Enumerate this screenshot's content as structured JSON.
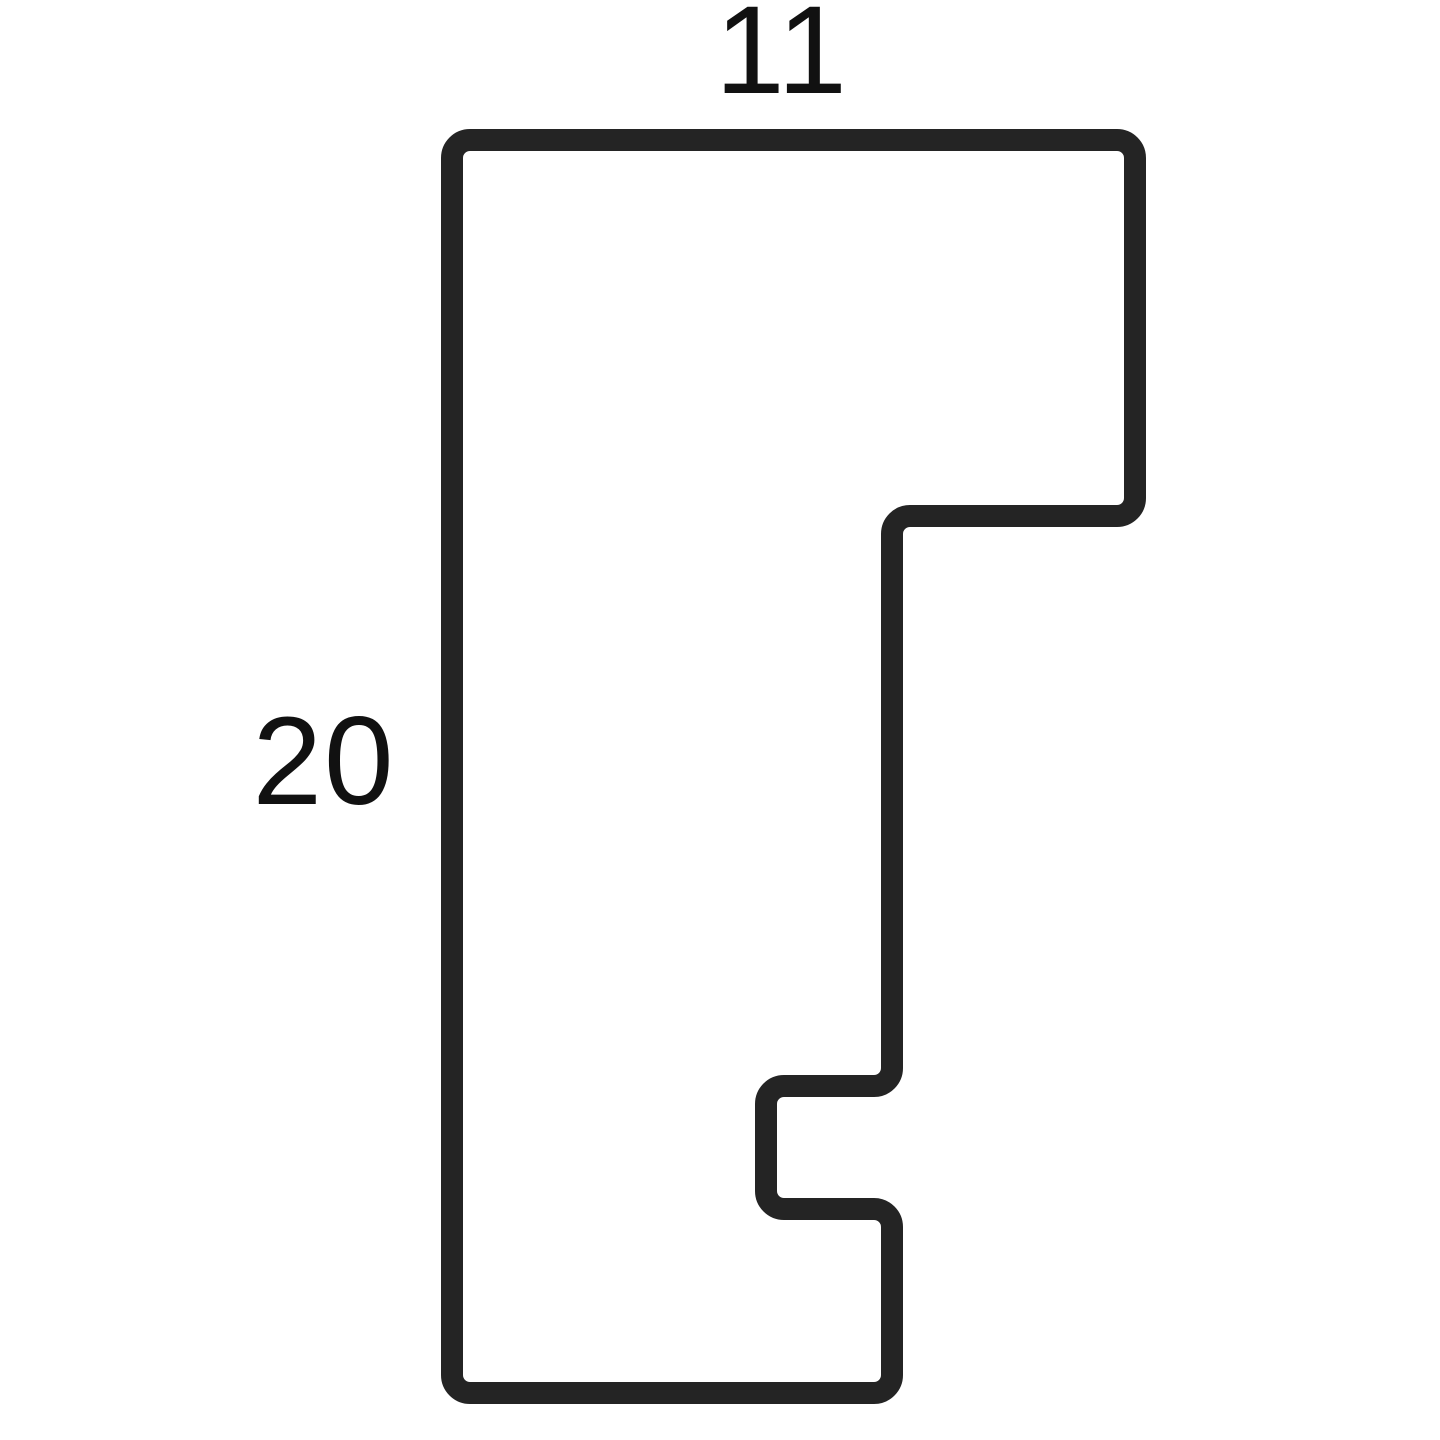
{
  "diagram": {
    "title": "moulding-profile-cross-section",
    "dimensions": {
      "width_label": "11",
      "height_label": "20"
    },
    "colors": {
      "outline": "#242424",
      "label": "#111111",
      "background": "#ffffff"
    }
  }
}
